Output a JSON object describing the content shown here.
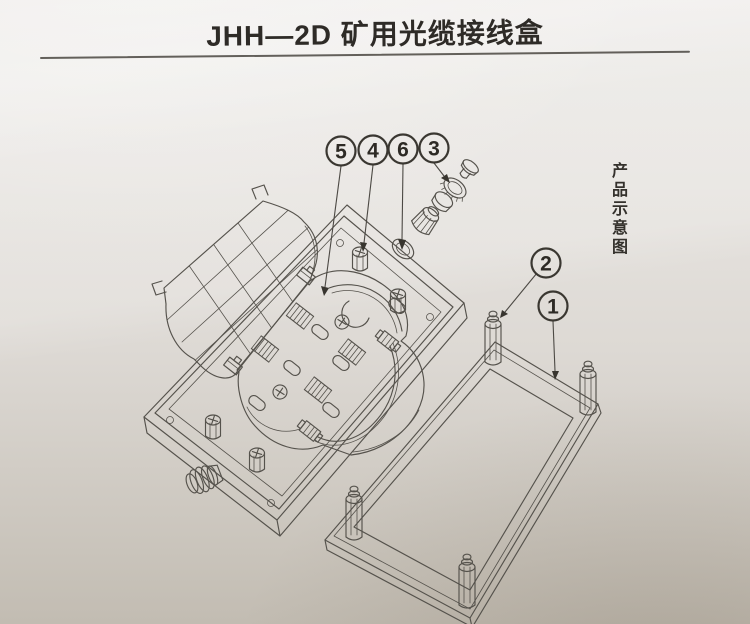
{
  "header": {
    "title": "JHH—2D 矿用光缆接线盒"
  },
  "side_note": {
    "label": "产品示意图"
  },
  "callouts": [
    {
      "label": "5"
    },
    {
      "label": "4"
    },
    {
      "label": "6"
    },
    {
      "label": "3"
    },
    {
      "label": "2"
    },
    {
      "label": "1"
    }
  ],
  "colors": {
    "paper-top": "#edebe8",
    "paper-mid": "#ddd9d4",
    "paper-bottom": "#c2bcb2",
    "line": "#55524c",
    "ink": "#2e2b27"
  }
}
